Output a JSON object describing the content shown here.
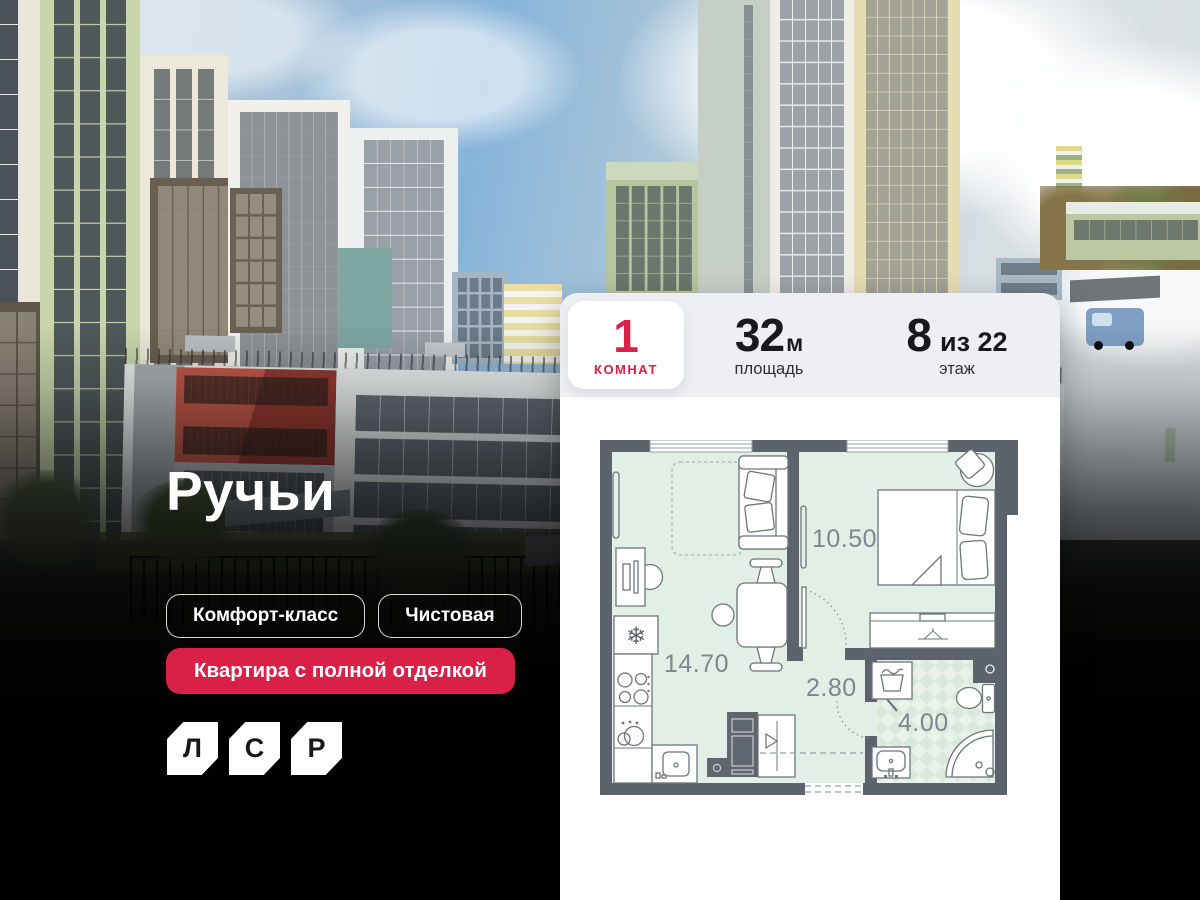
{
  "hero": {
    "title": "Ручьи",
    "tags": [
      "Комфорт-класс",
      "Чистовая"
    ],
    "accent_tag": "Квартира с полной отделкой",
    "logo_letters": [
      "Л",
      "С",
      "Р"
    ]
  },
  "card": {
    "rooms": {
      "value": "1",
      "label": "комнат"
    },
    "area": {
      "value": "32",
      "unit": "м",
      "label": "площадь"
    },
    "floor": {
      "value": "8",
      "suffix": "из 22",
      "label": "этаж"
    },
    "floorplan": {
      "labels": {
        "living_kitchen": "14.70",
        "bedroom": "10.50",
        "hall": "2.80",
        "bathroom": "4.00"
      }
    }
  },
  "colors": {
    "accent": "#D92147",
    "wall": "#5C636C",
    "floor": "#E2EFE6",
    "header_bg": "#EDEFF2"
  }
}
